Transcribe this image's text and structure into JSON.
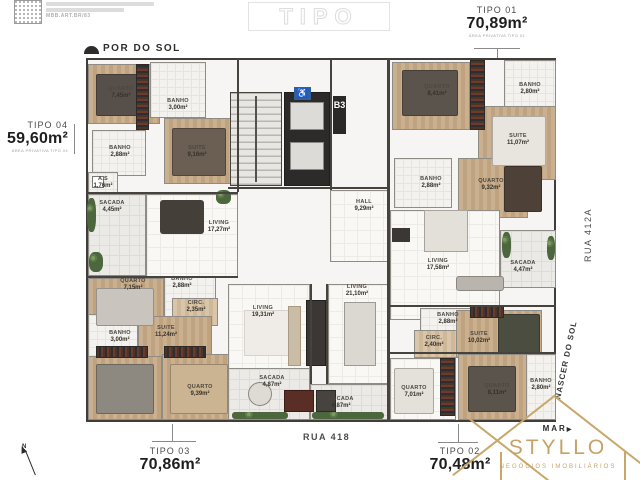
{
  "meta": {
    "qr_link": "MBB.ART.BR/83"
  },
  "watermark": "TIPO",
  "orientation": {
    "sunset_label": "POR DO SOL",
    "sunrise_label": "NASCER DO SOL",
    "compass_n": "N"
  },
  "streets": {
    "bottom": "RUA 418",
    "right": "RUA 412A"
  },
  "units": [
    {
      "label": "TIPO 01",
      "area": "70,89m²",
      "caption": "ÁREA PRIVATIVA TIPO 01"
    },
    {
      "label": "TIPO 02",
      "area": "70,48m²",
      "caption": "ÁREA PRIVATIVA TIPO 02"
    },
    {
      "label": "TIPO 03",
      "area": "70,86m²",
      "caption": "ÁREA PRIVATIVA TIPO 03"
    },
    {
      "label": "TIPO 04",
      "area": "59,60m²",
      "caption": "ÁREA PRIVATIVA TIPO 04"
    }
  ],
  "core": {
    "elevator_sign": "B3",
    "accessibility_icon": "♿"
  },
  "rooms": [
    {
      "name": "QUARTO",
      "area": "7,45m²"
    },
    {
      "name": "BANHO",
      "area": "3,00m²"
    },
    {
      "name": "SUITE",
      "area": "9,16m²"
    },
    {
      "name": "BANHO",
      "area": "2,88m²"
    },
    {
      "name": "A.S",
      "area": "1,76m²"
    },
    {
      "name": "SACADA",
      "area": "4,45m²"
    },
    {
      "name": "LIVING",
      "area": "17,27m²"
    },
    {
      "name": "QUARTO",
      "area": "7,15m²"
    },
    {
      "name": "BANHO",
      "area": "2,88m²"
    },
    {
      "name": "CIRC.",
      "area": "2,35m²"
    },
    {
      "name": "SUITE",
      "area": "11,24m²"
    },
    {
      "name": "BANHO",
      "area": "3,00m²"
    },
    {
      "name": "QUARTO",
      "area": "9,39m²"
    },
    {
      "name": "LIVING",
      "area": "19,31m²"
    },
    {
      "name": "SACADA",
      "area": "4,87m²"
    },
    {
      "name": "LIVING",
      "area": "21,10m²"
    },
    {
      "name": "SACADA",
      "area": "4,87m²"
    },
    {
      "name": "HALL",
      "area": "9,29m²"
    },
    {
      "name": "QUARTO",
      "area": "8,41m²"
    },
    {
      "name": "BANHO",
      "area": "2,80m²"
    },
    {
      "name": "SUITE",
      "area": "11,07m²"
    },
    {
      "name": "BANHO",
      "area": "2,88m²"
    },
    {
      "name": "QUARTO",
      "area": "9,32m²"
    },
    {
      "name": "LIVING",
      "area": "17,58m²"
    },
    {
      "name": "SACADA",
      "area": "4,47m²"
    },
    {
      "name": "BANHO",
      "area": "2,88m²"
    },
    {
      "name": "CIRC.",
      "area": "2,40m²"
    },
    {
      "name": "SUITE",
      "area": "10,02m²"
    },
    {
      "name": "QUARTO",
      "area": "7,01m²"
    },
    {
      "name": "QUARTO",
      "area": "8,11m²"
    },
    {
      "name": "BANHO",
      "area": "2,80m²"
    }
  ],
  "logo": {
    "brand_top": "MAR",
    "brand_arrow": "▶",
    "brand_name": "STYLLO",
    "brand_subtitle": "NEGÓCIOS IMOBILIÁRIOS"
  },
  "colors": {
    "gold": "#c5a368",
    "wall": "#46433f",
    "accessibility_blue": "#2f5f9e"
  }
}
